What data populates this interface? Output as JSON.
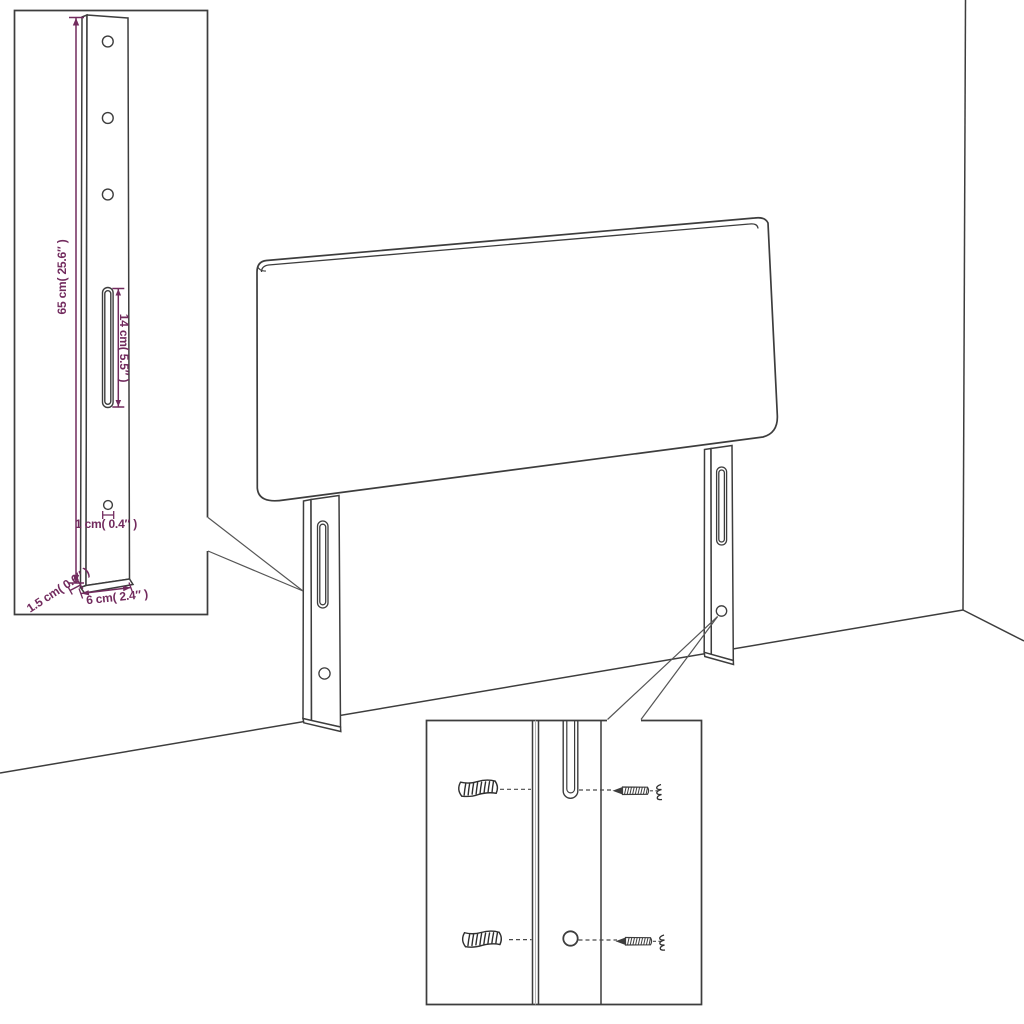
{
  "diagram": {
    "kind": "product-dimension-diagram",
    "subject": "upholstered headboard with two slotted mounting legs shown against a room corner",
    "colors": {
      "line": "#3d3d3d",
      "dimension": "#722b5e",
      "background": "#ffffff"
    },
    "labels": {
      "leg_height": "65 cm( 25.6″ )",
      "slot_length": "14 cm( 5.5″ )",
      "hole_diameter": "1 cm( 0.4″ )",
      "leg_thickness": "1.5 cm( 0.6″ )",
      "leg_width": "6 cm( 2.4″ )"
    },
    "insets": {
      "leg_detail": {
        "contents": "single mounting leg with 3 holes, long slot, small hole, all dimensions"
      },
      "mounting_detail": {
        "contents": "leg close-up with 2 wall plugs and 2 screws aligned to slot and hole"
      }
    }
  }
}
